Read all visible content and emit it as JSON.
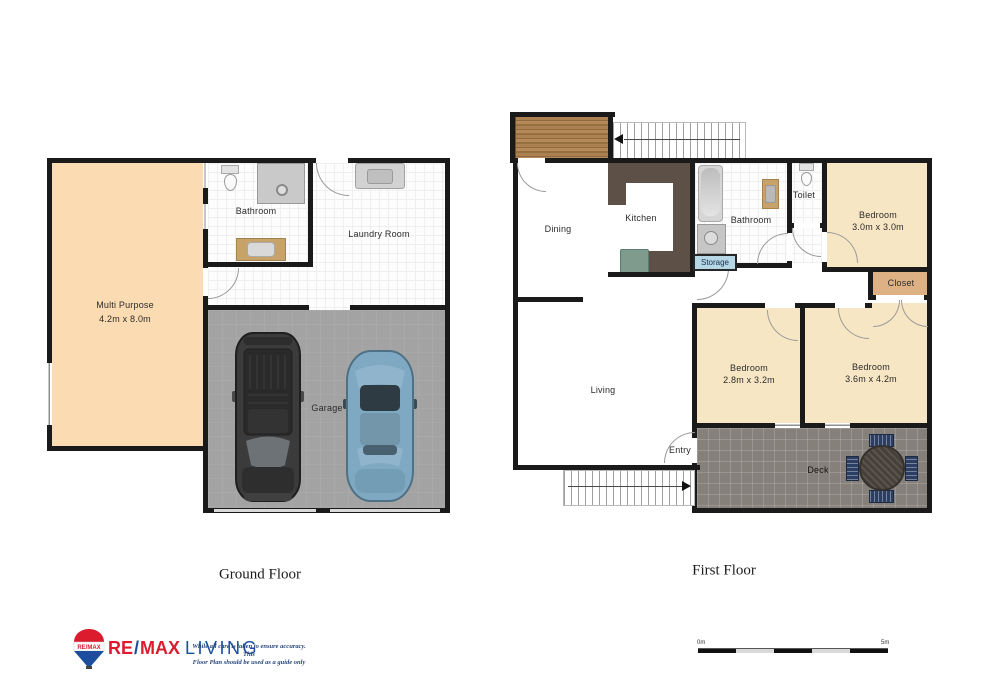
{
  "floors": {
    "ground": {
      "title": "Ground Floor",
      "multi_purpose": "Multi Purpose",
      "multi_purpose_dims": "4.2m x 8.0m",
      "bathroom": "Bathroom",
      "laundry": "Laundry Room",
      "garage": "Garage"
    },
    "first": {
      "title": "First Floor",
      "dining": "Dining",
      "kitchen": "Kitchen",
      "bathroom": "Bathroom",
      "toilet": "Toilet",
      "storage": "Storage",
      "bedroom1": "Bedroom",
      "bedroom1_dims": "3.0m x 3.0m",
      "closet": "Closet",
      "bedroom2": "Bedroom",
      "bedroom2_dims": "2.8m x 3.2m",
      "bedroom3": "Bedroom",
      "bedroom3_dims": "3.6m x 4.2m",
      "living": "Living",
      "entry": "Entry",
      "deck": "Deck"
    }
  },
  "footer": {
    "balloon_label": "RE/MAX",
    "logo_re": "RE",
    "logo_slash": "/",
    "logo_max": "MAX",
    "logo_suffix": "LIVING",
    "disclaimer1": "While all care is taken to ensure accuracy. This",
    "disclaimer2": "Floor Plan should be used as a guide only",
    "scale_start": "0m",
    "scale_end": "5m"
  },
  "colors": {
    "wall": "#1a1a1a",
    "peach": "#fbdcb2",
    "peach_light": "#f7e6c3",
    "closet_tan": "#ddb184",
    "vanity_tan": "#c8a369",
    "garage_gray": "#a3a3a3",
    "deck_gray": "#86807a",
    "balcony_wood": "#a87f50",
    "counter_brown": "#5c5047",
    "appliance_green": "#7e9b8e",
    "storage_blue": "#b5d7e6",
    "chair_navy": "#2c3f63",
    "car_dark": "#3b3b3b",
    "car_blue": "#7fa8c2",
    "remax_red": "#dc1c2e",
    "remax_blue": "#1c4e9e",
    "scale_light": "#d9d9d9"
  }
}
